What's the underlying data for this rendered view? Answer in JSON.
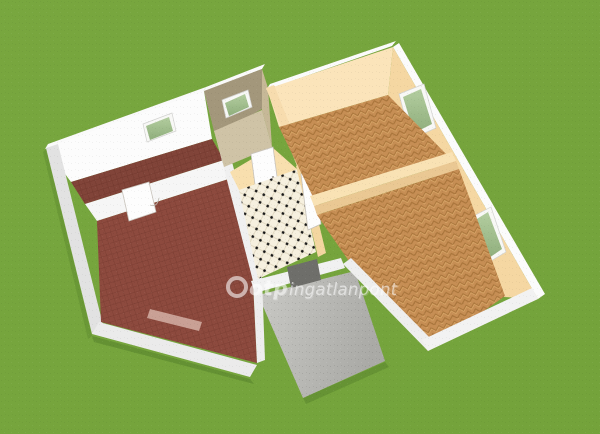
{
  "watermark": {
    "logo": "otp-ring-logo",
    "brand": "otp",
    "suffix": "ingatlanpont"
  },
  "palette": {
    "grass": "#76a53d",
    "wall_white": "#f4f4f4",
    "wall_peach": "#f8dfb2",
    "wall_khaki": "#a3977b",
    "floor_tile_red": "#8d4a3e",
    "floor_parquet": "#c58d53",
    "floor_checker": "#f6f0df",
    "floor_khaki_beige": "#cfc3a6",
    "terrace_concrete": "#bcbcb8",
    "window_glass_green": "#a3c295",
    "door_white": "#fdfdfd",
    "entry_mat_gray": "#6e6e6a"
  },
  "scene": {
    "type": "3d-floor-plan-render",
    "rooms": [
      {
        "id": "left-back-room",
        "floor": "red-brick-tile",
        "walls": "white",
        "windows": 1
      },
      {
        "id": "left-front-room",
        "floor": "red-brick-tile",
        "walls": "white",
        "windows": 1,
        "doors": 1
      },
      {
        "id": "center-back-room",
        "floor": "beige",
        "walls": "khaki",
        "windows": 1
      },
      {
        "id": "center-hall",
        "floor": "black-white-checker",
        "walls": "peach",
        "doors": 2
      },
      {
        "id": "right-back-room",
        "floor": "herringbone-parquet",
        "walls": "peach",
        "windows": 1
      },
      {
        "id": "right-front-room",
        "floor": "herringbone-parquet",
        "walls": "peach",
        "windows": 1
      },
      {
        "id": "terrace",
        "floor": "concrete-gray"
      }
    ]
  }
}
